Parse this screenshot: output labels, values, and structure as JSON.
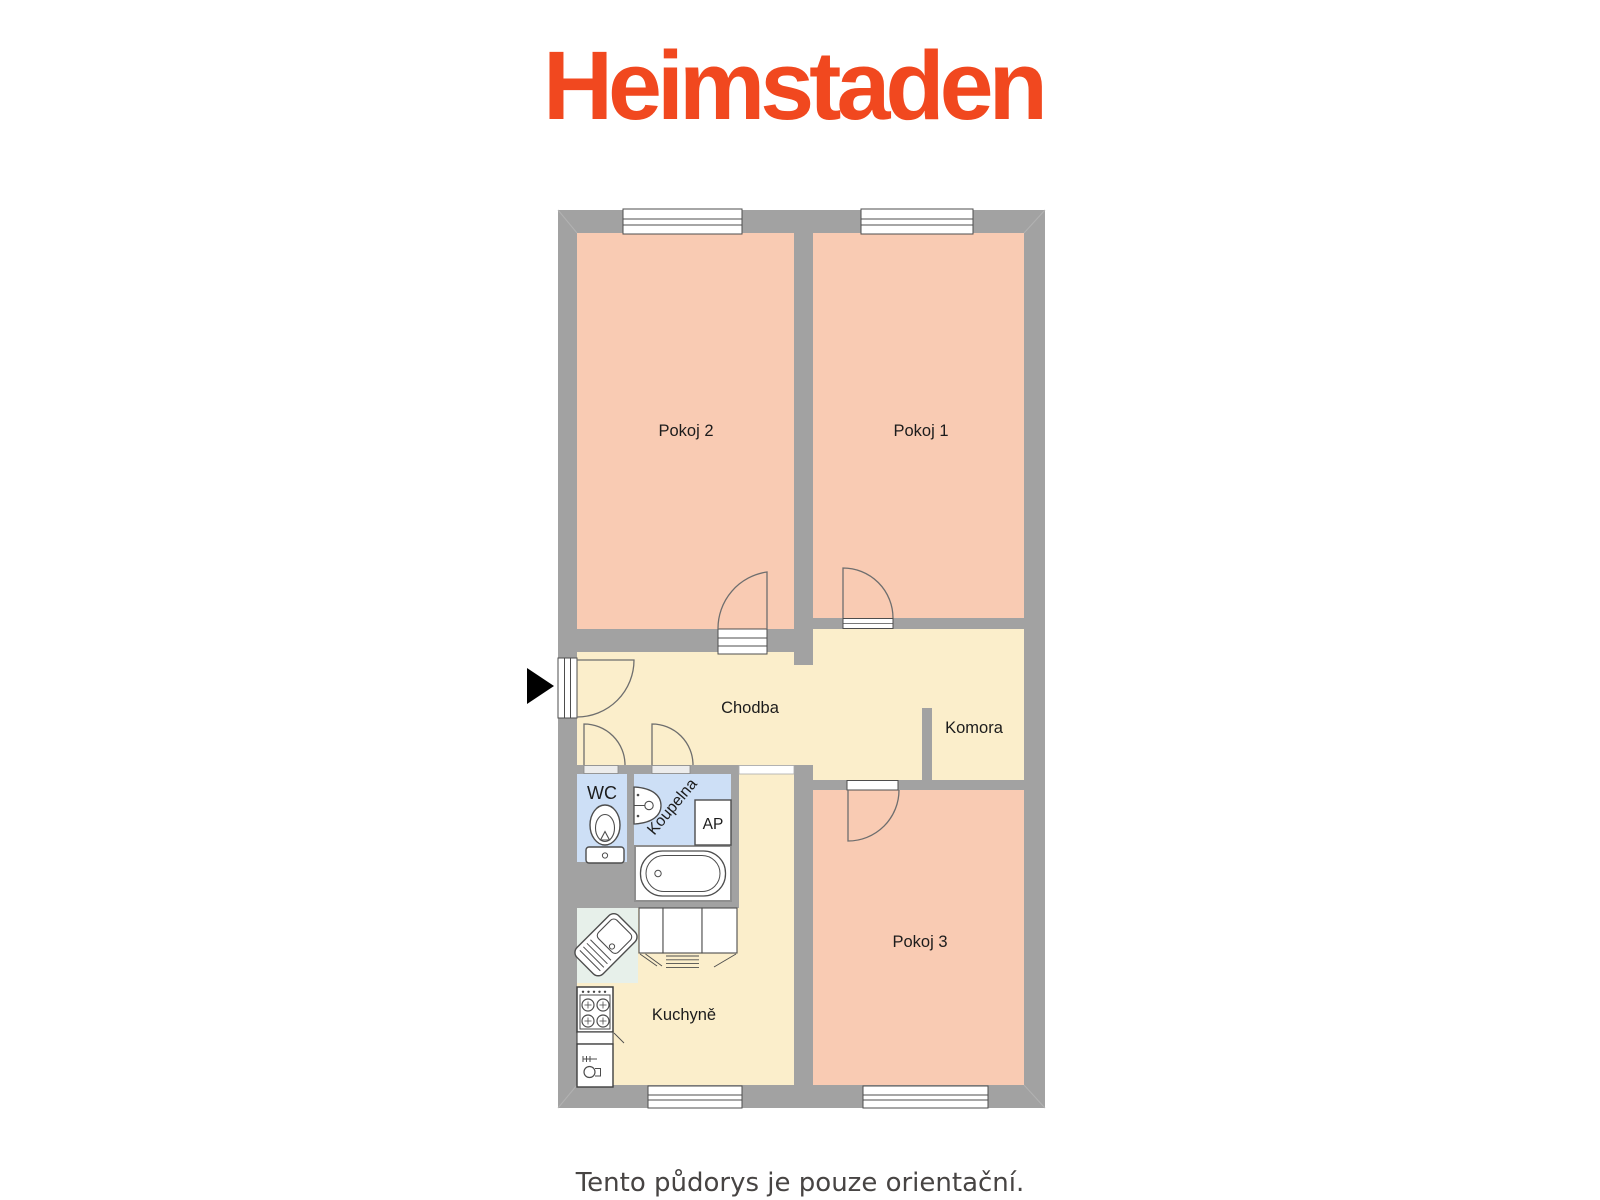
{
  "logo": {
    "text": "Heimstaden",
    "color": "#F1481F"
  },
  "footer": {
    "note": "Tento půdorys je pouze orientační."
  },
  "floor_plan": {
    "labels": {
      "pokoj1": "Pokoj 1",
      "pokoj2": "Pokoj 2",
      "pokoj3": "Pokoj 3",
      "chodba": "Chodba",
      "komora": "Komora",
      "wc": "WC",
      "koupelna": "Koupelna",
      "kuchyne": "Kuchyně",
      "ap": "AP"
    },
    "colors": {
      "wall": "#A2A2A2",
      "room_salmon": "#F9CBB3",
      "room_cream": "#FBEECB",
      "room_blue": "#CDDFF6",
      "sink_unit": "#E7F0EA",
      "opening_white": "#FFFFFF",
      "entrance_arrow": "#000000"
    }
  }
}
